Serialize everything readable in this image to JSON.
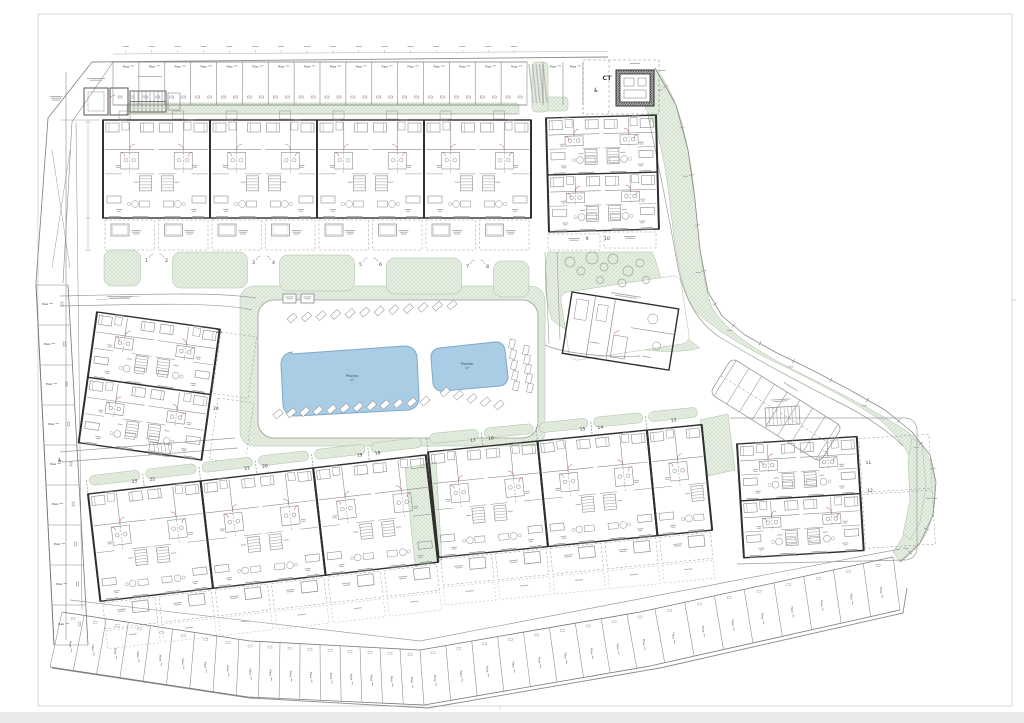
{
  "sheet": {
    "background": "#ffffff",
    "frame_color": "#d9d9d9",
    "shadow": "#e9e9e9"
  },
  "legend_colors": {
    "green_area": "#e6eee2",
    "green_hatch": "#bfd0b9",
    "green_edge": "#aabfa4",
    "pool_fill": "#aacde6",
    "pool_edge": "#7fa8c9",
    "pool_text": "#33659b",
    "wall_dark": "#2f2f2f",
    "line_mid": "#6f6f6f",
    "line_light": "#9c9c9c",
    "micro_text": "#9f9f9f",
    "accent_red": "#b85c5c",
    "tree_edge": "#98a898"
  },
  "ct": {
    "label": "CT"
  },
  "pools": {
    "large": {
      "label": "Piscina",
      "area_suffix": "m²"
    },
    "small": {
      "label": "Piscina",
      "area_suffix": "m²"
    }
  },
  "parking": {
    "stall_label": "Plaza",
    "accessible_icon": "♿",
    "rows": {
      "top": {
        "count": 16
      },
      "top_east": {
        "count": 2
      },
      "left": {
        "count": 9
      },
      "bottom": {
        "count": 34
      },
      "diagonal": {
        "count": 8
      }
    }
  },
  "units": {
    "top_row_gardens": [
      "1",
      "2",
      "3",
      "4",
      "5",
      "6",
      "7",
      "8"
    ],
    "block_b_gardens": [
      "9",
      "10"
    ],
    "block_h_gardens": [
      "11",
      "12"
    ],
    "block_g_gardens": [
      "17",
      "16",
      "15",
      "14",
      "13"
    ],
    "block_f_gardens": [
      "23",
      "22",
      "21",
      "20",
      "19",
      "18"
    ],
    "block_c_gardens": [
      "25",
      "24"
    ]
  }
}
